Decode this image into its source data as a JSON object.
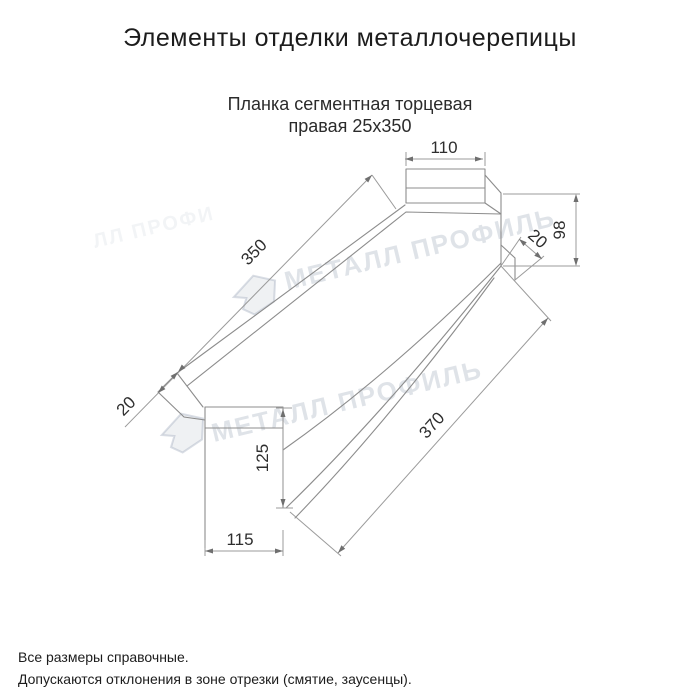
{
  "header": {
    "title": "Элементы отделки металлочерепицы"
  },
  "product": {
    "name_line1": "Планка сегментная торцевая",
    "name_line2": "правая 25х350"
  },
  "dimensions": {
    "top_tab_width": "110",
    "length_top": "350",
    "length_bottom": "370",
    "hem_left": "20",
    "hem_right": "20",
    "right_end_height": "98",
    "end_plate_height": "125",
    "end_plate_width": "115"
  },
  "watermark": {
    "text": "МЕТАЛЛ ПРОФИЛЬ",
    "partial": "ЛЛ ПРОФИ",
    "color": "#8d99ad"
  },
  "footer": {
    "note1": "Все размеры справочные.",
    "note2": "Допускаются отклонения в зоне отрезки (смятие, заусенцы)."
  }
}
